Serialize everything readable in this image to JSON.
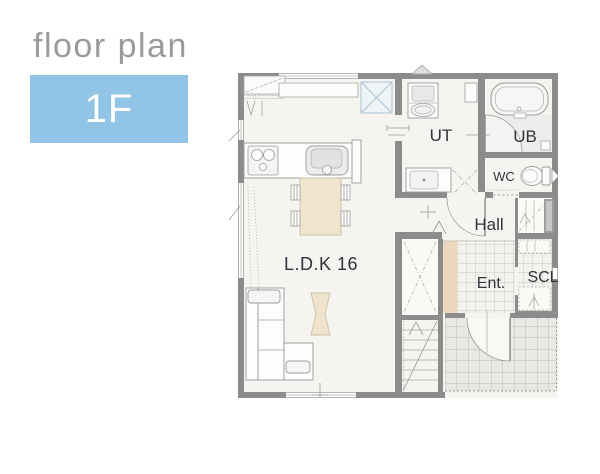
{
  "header": {
    "title": "floor plan",
    "floor_label": "1F"
  },
  "plan": {
    "rooms": {
      "ldk": "L.D.K 16",
      "ut": "UT",
      "ub": "UB",
      "wc": "WC",
      "hall": "Hall",
      "entrance": "Ent.",
      "scl": "SCL"
    }
  },
  "colors": {
    "accent_blue": "#92c4e7",
    "title_gray": "#9b9b9b",
    "wall_gray": "#8c8c8c",
    "floor_cream": "#f6f4f0",
    "step_tan": "#ecd9bd",
    "furniture_tan": "#f0e4cc",
    "label_ink": "#32323c"
  }
}
